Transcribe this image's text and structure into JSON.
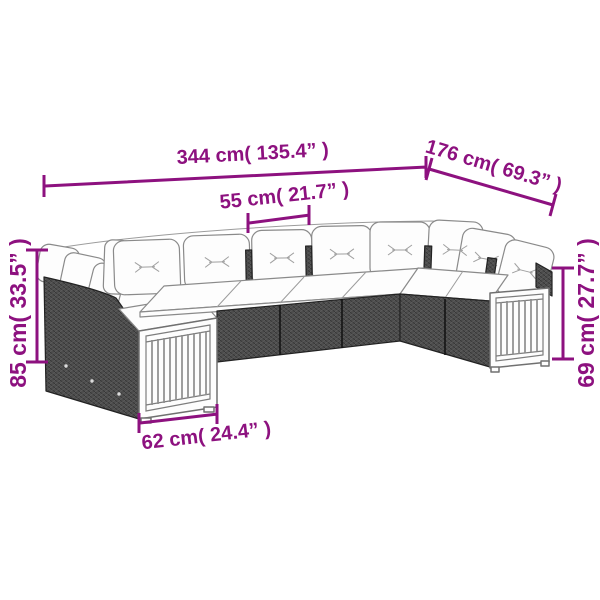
{
  "meta": {
    "type": "product-dimension-diagram",
    "background": "#ffffff"
  },
  "colors": {
    "accent": "#8d117f",
    "wicker": "#4d4d4d",
    "cushion": "#fdfdfd"
  },
  "product": {
    "description": "U-shaped poly rattan garden lounge set with white cushions and wood slat end panels"
  },
  "dimensions": {
    "total_width": "344 cm( 135.4” )",
    "side_depth": "176 cm( 69.3” )",
    "seat_width": "55 cm( 21.7” )",
    "back_height": "85 cm( 33.5” )",
    "arm_height": "69 cm( 27.7” )",
    "end_panel_width": "62 cm( 24.4” )"
  }
}
